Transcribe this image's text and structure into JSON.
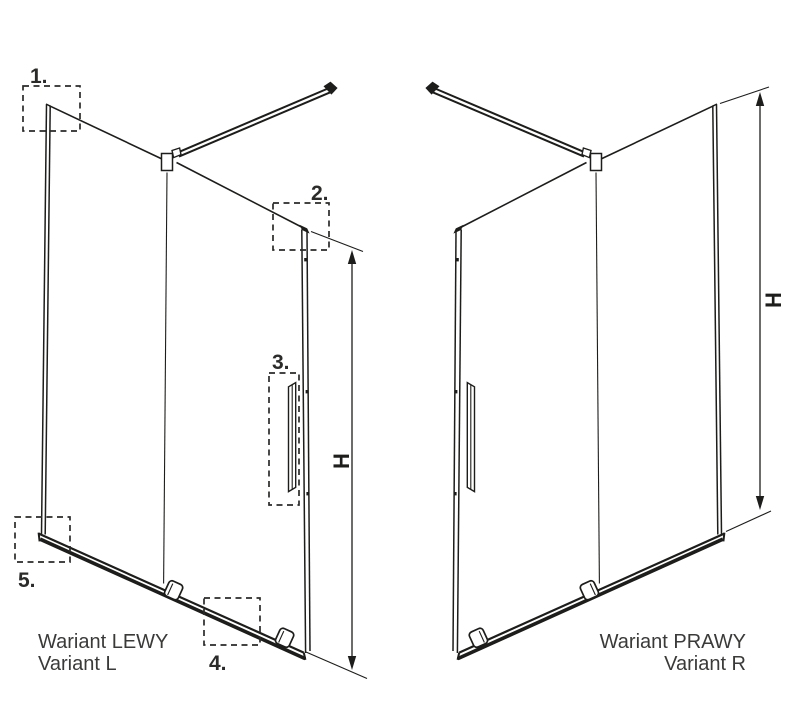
{
  "colors": {
    "line": "#1d1d1b",
    "callout_label": "#2b2b2a",
    "caption_text": "#3a3a39",
    "background": "#ffffff"
  },
  "left": {
    "caption_line1": "Wariant LEWY",
    "caption_line2": "Variant L",
    "dimension_label": "H",
    "callouts": [
      {
        "label": "1."
      },
      {
        "label": "2."
      },
      {
        "label": "3."
      },
      {
        "label": "4."
      },
      {
        "label": "5."
      }
    ]
  },
  "right": {
    "caption_line1": "Wariant PRAWY",
    "caption_line2": "Variant R",
    "dimension_label": "H"
  }
}
